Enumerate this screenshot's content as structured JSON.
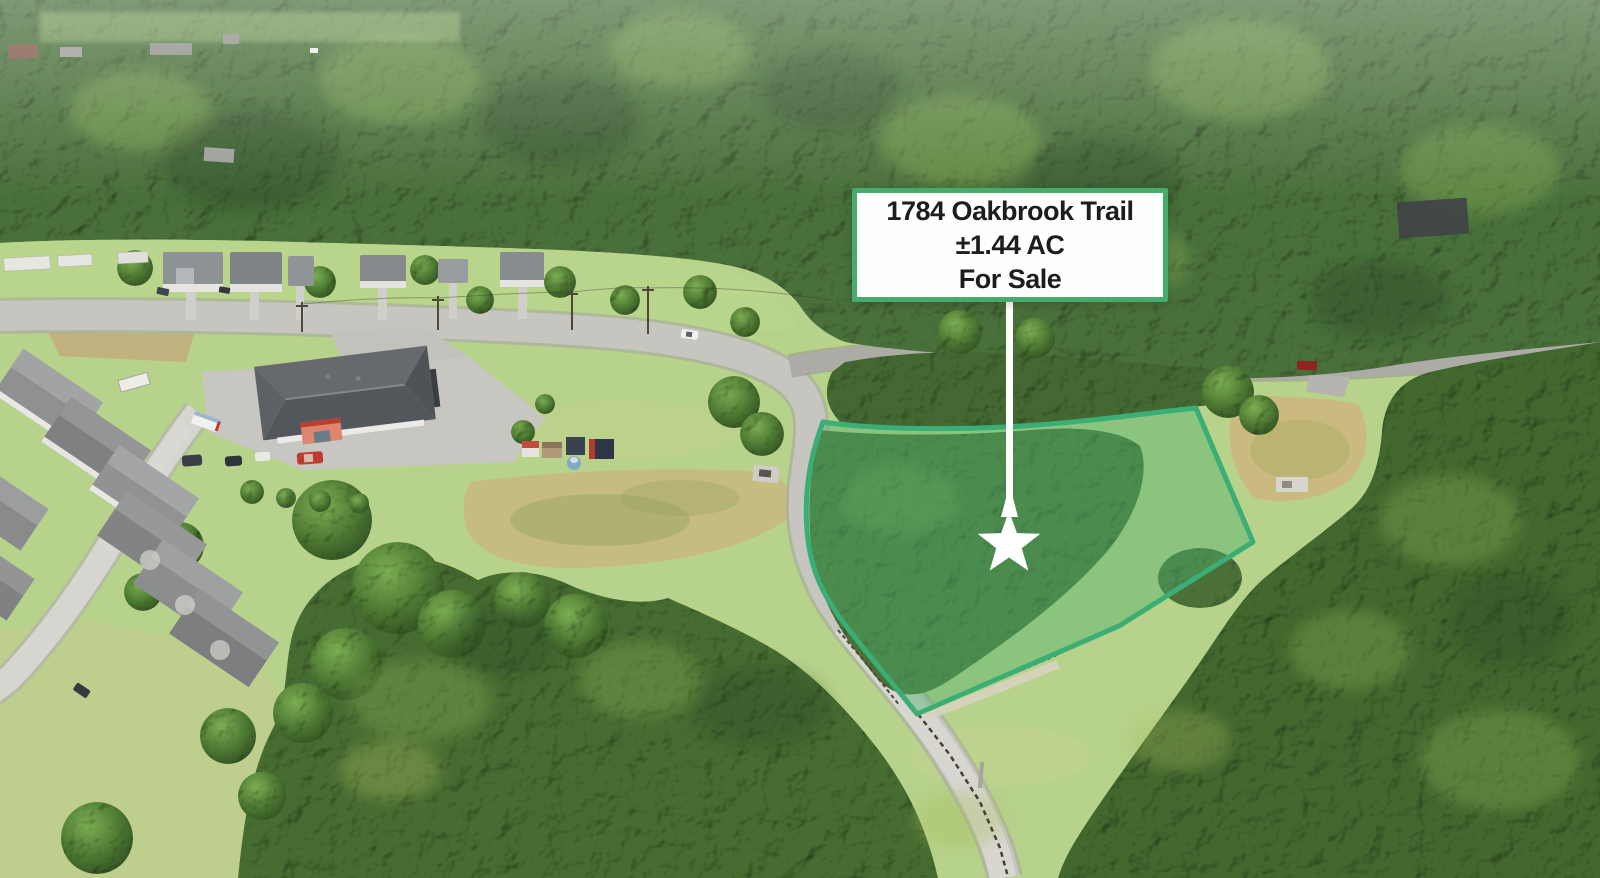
{
  "image_type": "aerial-property-listing-photo",
  "listing_card": {
    "address": "1784 Oakbrook Trail",
    "acreage": "±1.44 AC",
    "status": "For Sale",
    "background": "#fdfffd",
    "border_color": "#47ab6d",
    "text_color": "#1d1d1b"
  },
  "parcel": {
    "fill": "#4cb06e",
    "stroke": "#3aae74"
  },
  "marker": {
    "color": "#ffffff",
    "shape": "star"
  }
}
